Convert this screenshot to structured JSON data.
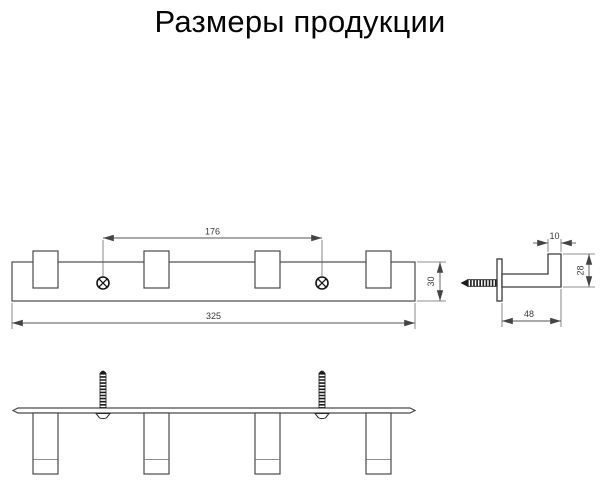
{
  "title": "Размеры продукции",
  "dims": {
    "hole_spacing": "176",
    "total_length": "325",
    "rail_height": "30",
    "hook_lip_width": "10",
    "hook_height": "28",
    "hook_depth": "48"
  }
}
